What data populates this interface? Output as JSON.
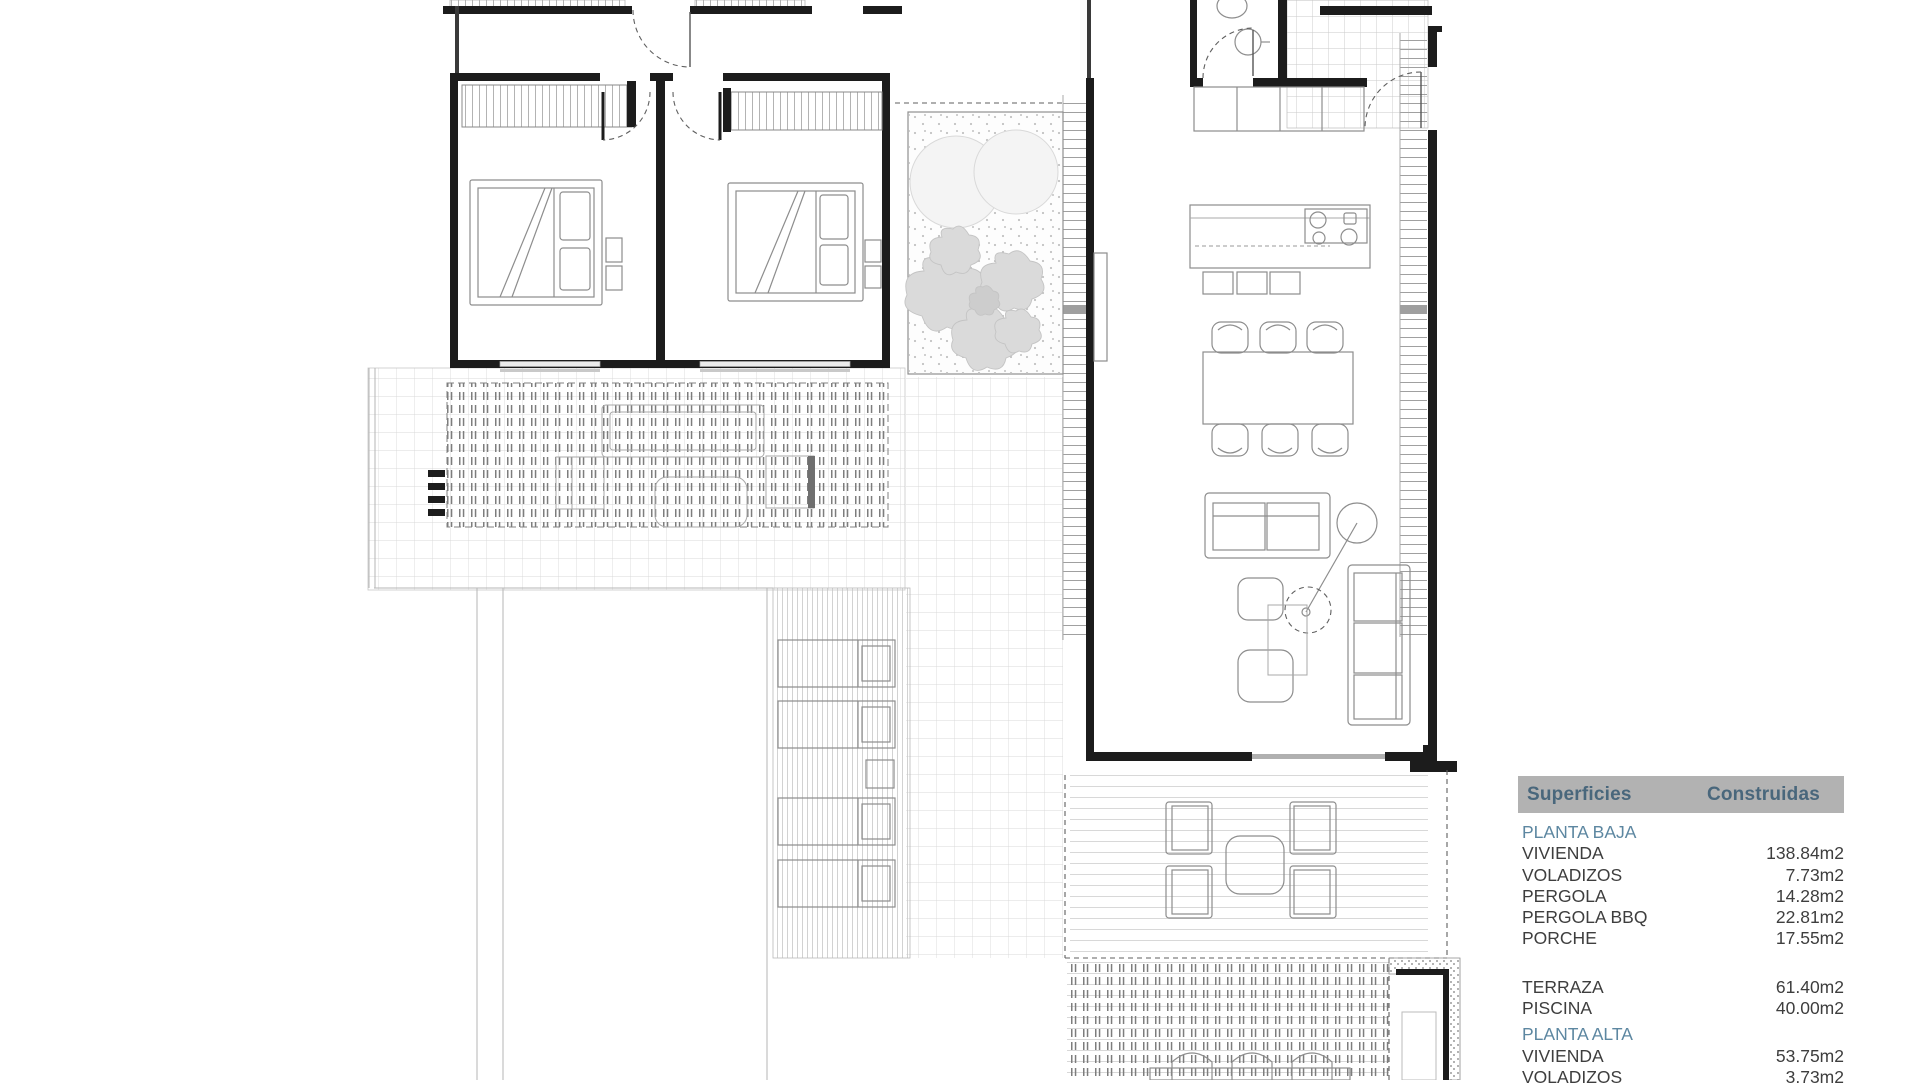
{
  "panel": {
    "header": {
      "left": "Superficies",
      "right": "Construidas"
    },
    "sections": [
      {
        "title": "PLANTA BAJA",
        "rows": [
          {
            "label": "VIVIENDA",
            "value": "138.84m2"
          },
          {
            "label": "VOLADIZOS",
            "value": "7.73m2"
          },
          {
            "label": "PERGOLA",
            "value": "14.28m2"
          },
          {
            "label": "PERGOLA BBQ",
            "value": "22.81m2"
          },
          {
            "label": "PORCHE",
            "value": "17.55m2"
          }
        ]
      },
      {
        "title": "",
        "rows": [
          {
            "label": "TERRAZA",
            "value": "61.40m2"
          },
          {
            "label": "PISCINA",
            "value": "40.00m2"
          }
        ]
      },
      {
        "title": "PLANTA ALTA",
        "rows": [
          {
            "label": "VIVIENDA",
            "value": "53.75m2"
          },
          {
            "label": "VOLADIZOS",
            "value": "3.73m2"
          }
        ]
      }
    ]
  },
  "theme": {
    "wall": "#1c1c1c",
    "furn": "#8d8d8d",
    "dash": "#5f5f5f",
    "glass": "#b0b0b0",
    "hdrbg": "#b2b2b2",
    "hdrtx": "#49677c",
    "sectx": "#5d87a1",
    "rowtx": "#3e3e3e"
  }
}
